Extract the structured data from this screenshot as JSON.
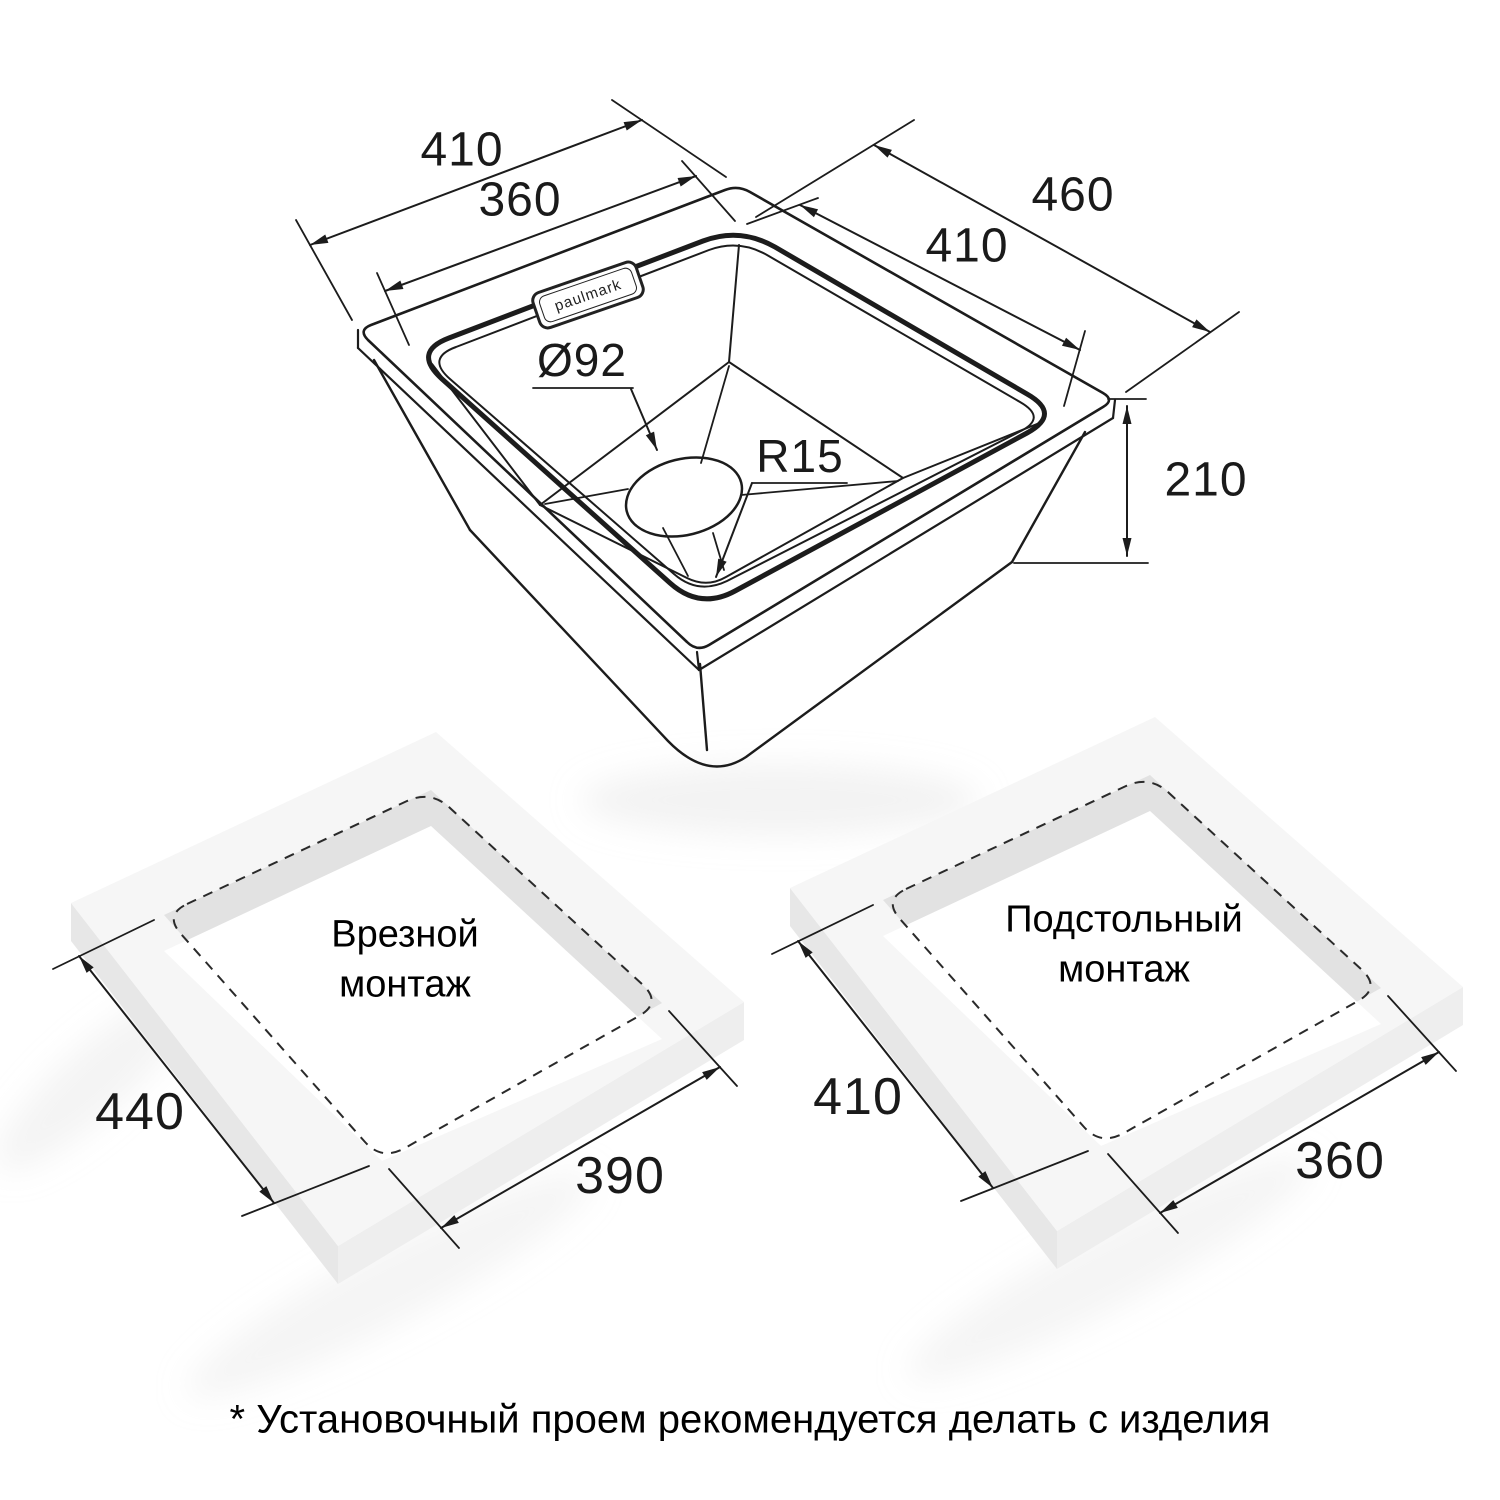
{
  "sink": {
    "logo": "paulmark",
    "dim_top_outer": "410",
    "dim_top_inner": "360",
    "dim_right_outer": "460",
    "dim_right_inner": "410",
    "dim_depth": "210",
    "drain_diameter": "Ø92",
    "corner_radius": "R15"
  },
  "mount_left": {
    "title_line1": "Врезной",
    "title_line2": "монтаж",
    "dim_side": "440",
    "dim_front": "390"
  },
  "mount_right": {
    "title_line1": "Подстольный",
    "title_line2": "монтаж",
    "dim_side": "410",
    "dim_front": "360"
  },
  "footnote": "* Установочный проем рекомендуется делать с изделия",
  "colors": {
    "line": "#1c1c1c",
    "slab_top": "#f6f6f6",
    "slab_side_left": "#e7e7e7",
    "slab_side_right": "#eeeeee",
    "cutout_wall": "#e2e2e2",
    "background": "#ffffff"
  }
}
